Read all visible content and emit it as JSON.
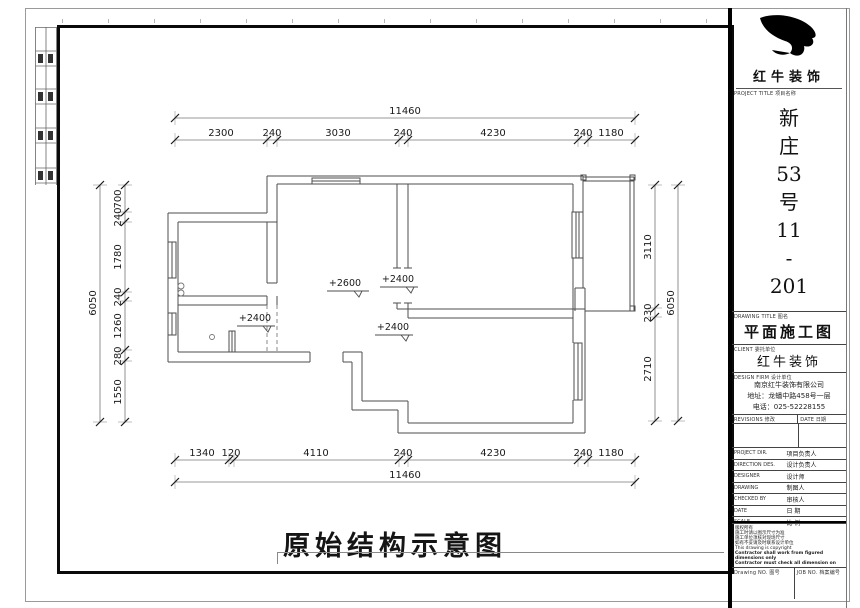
{
  "caption": "原始结构示意图",
  "plan": {
    "dims": {
      "top_total": "11460",
      "top": [
        "2300",
        "240",
        "3030",
        "240",
        "4230",
        "240",
        "1180"
      ],
      "bottom": [
        "1340",
        "120",
        "4110",
        "240",
        "4230",
        "240",
        "1180"
      ],
      "bottom_total": "11460",
      "left": [
        "700",
        "240",
        "1780",
        "240",
        "1260",
        "280",
        "1550"
      ],
      "left_total": "6050",
      "right": [
        "3110",
        "230",
        "2710"
      ],
      "right_total": "6050"
    },
    "elevations": [
      "+2600",
      "+2400",
      "+2400",
      "+2400"
    ]
  },
  "titleblock": {
    "brand": "红牛装饰",
    "project_label": "PROJECT TITLE 项目名称",
    "project_chars": [
      "新",
      "庄",
      "53",
      "号",
      "11",
      "-",
      "201"
    ],
    "drawing_label": "DRAWING TITLE 图名",
    "drawing_title": "平面施工图",
    "client_label": "CLIENT 委托单位",
    "client_name": "红牛装饰",
    "firm_label": "DESIGN FIRM 设计单位",
    "firm_lines": [
      "南京红牛装饰有限公司",
      "地址：龙蟠中路458号一层",
      "电话：025-52228155"
    ],
    "revisions_label": "REVISIONS 修改",
    "date_col_label": "DATE 日期",
    "rows": [
      {
        "label": "PROJECT DIR.",
        "value": "项目负责人"
      },
      {
        "label": "DIRECTION DES.",
        "value": "设计负责人"
      },
      {
        "label": "DESIGNER",
        "value": "设计师"
      },
      {
        "label": "DRAWING",
        "value": "制图人"
      },
      {
        "label": "CHECKED BY",
        "value": "审核人"
      },
      {
        "label": "DATE",
        "value": "日  期"
      },
      {
        "label": "SCALE",
        "value": "比  例"
      }
    ],
    "notes": [
      "版权所有",
      "施工时请以图示尺寸为准",
      "施工单位须核对现场尺寸",
      "如有不妥请及时联系设计单位",
      "This drawing is copyright",
      "Contractor shall work from figured dimensions only",
      "Contractor must check all dimension on site",
      "Contractor must be reported immediately to architects"
    ],
    "drawing_no_label": "Drawing NO. 图号",
    "job_no_label": "JOB NO. 档案编号"
  }
}
